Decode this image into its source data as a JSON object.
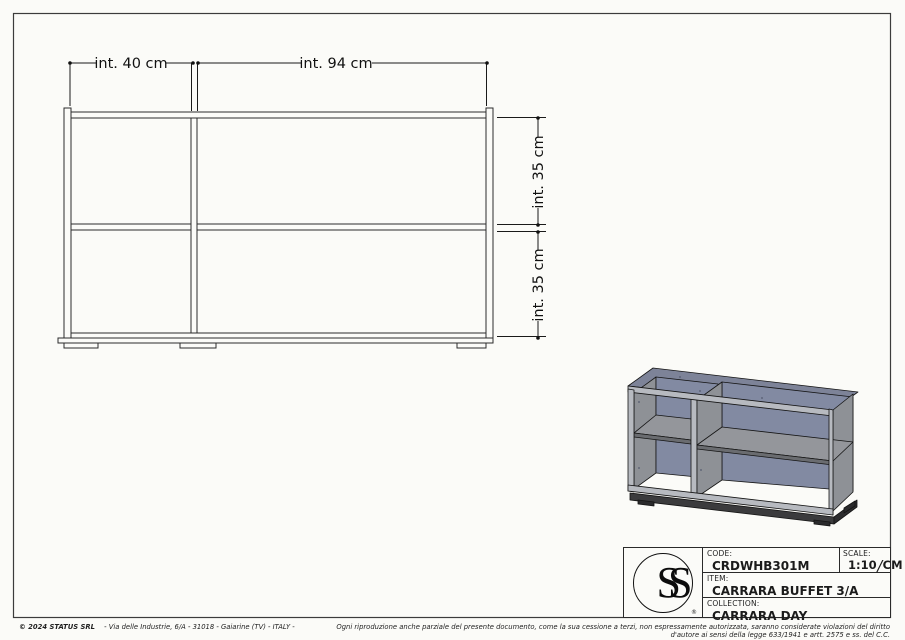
{
  "sheet": {
    "background": "#fbfbf8",
    "border_color": "#3c3c3c"
  },
  "front_view": {
    "dim_width_left": "int. 40 cm",
    "dim_width_right": "int. 94 cm",
    "dim_height_upper": "int. 35 cm",
    "dim_height_lower": "int. 35 cm"
  },
  "iso_view": {
    "colors": {
      "top": "#7d8398",
      "back_panel": "#828aa2",
      "side": "#8e9196",
      "shelf": "#94969b",
      "shelf_edge": "#6a6c70",
      "front_edge": "#b7bac0",
      "plinth": "#3b3b3d"
    }
  },
  "title_block": {
    "logo_text": "SS",
    "registered_mark": "®",
    "code_label": "CODE:",
    "code_value": "CRDWHB301M",
    "scale_label": "SCALE:",
    "scale_value": "1:10",
    "scale_separator": "/",
    "scale_unit": "CM",
    "item_label": "ITEM:",
    "item_value": "CARRARA BUFFET 3/A",
    "collection_label": "COLLECTION:",
    "collection_value": "CARRARA DAY"
  },
  "footer": {
    "copyright": "© 2024 STATUS SRL",
    "address": "- Via delle Industrie, 6/A - 31018 - Gaiarine (TV) - ITALY -",
    "legal": "Ogni riproduzione anche parziale del presente documento, come la sua cessione a terzi, non espressamente autorizzata, saranno considerate violazioni del diritto d'autore ai sensi della legge 633/1941 e artt. 2575 e ss. del C.C."
  }
}
